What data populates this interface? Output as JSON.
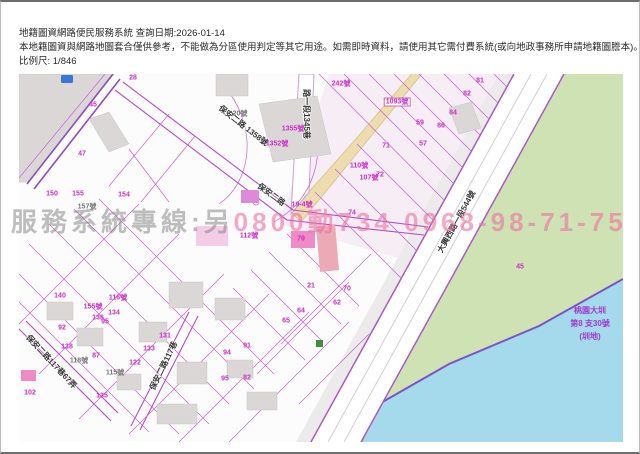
{
  "header": {
    "system_title_line": "地籍圖資網路便民服務系統 查詢日期:2026-01-14",
    "disclaimer_line": "本地籍圖資與網路地圖套合僅供參考，不能做為分區使用判定等其它用途。如需即時資料，請使用其它需付費系統(或向地政事務所申請地籍圖謄本)。",
    "scale_label": "比例尺: 1/846"
  },
  "watermark": {
    "service_text": "服務系統專線:另",
    "phone_text": "0800動734 0968-98-71-75"
  },
  "map": {
    "colors": {
      "map_bg": "#fdfcfc",
      "parcel_line": "#c95fd0",
      "road_edge": "#a85cc0",
      "water": "#a5d9ec",
      "field_green": "#cfe2b4",
      "building_gray": "#dbd7d7",
      "road_tan": "#ecdcae",
      "label_magenta": "#cb2ecb",
      "canal_text": "#a23ad6"
    },
    "labels": [
      {
        "text": "保安二路 1358號",
        "x": 224,
        "y": 52,
        "rot": 38,
        "cls": "lbl-road",
        "name": "road-label-baoan-2rd-1358"
      },
      {
        "text": "保安二路",
        "x": 252,
        "y": 121,
        "rot": 36,
        "cls": "lbl-road",
        "name": "road-label-baoan-2rd"
      },
      {
        "text": "路一段1345巷",
        "x": 287,
        "y": 40,
        "rot": 90,
        "cls": "lbl-road",
        "name": "road-label-lane-1345"
      },
      {
        "text": "大興西路一段544號",
        "x": 438,
        "y": 148,
        "rot": -61,
        "cls": "lbl-road",
        "name": "road-label-daxing-w-rd-544"
      },
      {
        "text": "保安二路117巷67弄",
        "x": 32,
        "y": 288,
        "rot": 47,
        "cls": "lbl-road",
        "name": "road-label-lane-117-alley-67"
      },
      {
        "text": "保安二路117巷",
        "x": 145,
        "y": 292,
        "rot": -64,
        "cls": "lbl-road",
        "name": "road-label-lane-117"
      },
      {
        "text": "桃園大圳",
        "x": 571,
        "y": 237,
        "cls": "lbl-canal",
        "name": "canal-label-line1"
      },
      {
        "text": "第8 支30號",
        "x": 571,
        "y": 250,
        "cls": "lbl-canal",
        "name": "canal-label-line2"
      },
      {
        "text": "(圳地)",
        "x": 571,
        "y": 263,
        "cls": "lbl-canal",
        "name": "canal-label-line3"
      },
      {
        "text": "242號",
        "x": 322,
        "y": 10,
        "cls": "lbl-parcel"
      },
      {
        "text": "1093號",
        "x": 378,
        "y": 28,
        "cls": "lbl-parcel lbl-box"
      },
      {
        "text": "1355號",
        "x": 274,
        "y": 55,
        "cls": "lbl-parcel"
      },
      {
        "text": "1352號",
        "x": 258,
        "y": 70,
        "cls": "lbl-parcel"
      },
      {
        "text": "20號",
        "x": 221,
        "y": 40,
        "cls": "lbl-gray"
      },
      {
        "text": "110號",
        "x": 340,
        "y": 92,
        "cls": "lbl-parcel"
      },
      {
        "text": "107號",
        "x": 350,
        "y": 104,
        "cls": "lbl-parcel"
      },
      {
        "text": "19-4號",
        "x": 283,
        "y": 131,
        "cls": "lbl-parcel"
      },
      {
        "text": "112號",
        "x": 230,
        "y": 162,
        "cls": "lbl-parcel"
      },
      {
        "text": "157號",
        "x": 68,
        "y": 133,
        "cls": "lbl-gray"
      },
      {
        "text": "155號",
        "x": 74,
        "y": 233,
        "cls": "lbl-parcel"
      },
      {
        "text": "116號",
        "x": 99,
        "y": 224,
        "cls": "lbl-parcel"
      },
      {
        "text": "118號",
        "x": 60,
        "y": 287,
        "cls": "lbl-gray"
      },
      {
        "text": "115號",
        "x": 96,
        "y": 299,
        "cls": "lbl-gray"
      },
      {
        "text": "45",
        "x": 74,
        "y": 31,
        "cls": "lbl-parcel"
      },
      {
        "text": "28",
        "x": 114,
        "y": 4,
        "cls": "lbl-parcel"
      },
      {
        "text": "47",
        "x": 63,
        "y": 80,
        "cls": "lbl-parcel"
      },
      {
        "text": "81",
        "x": 461,
        "y": 7,
        "cls": "lbl-parcel"
      },
      {
        "text": "82",
        "x": 448,
        "y": 20,
        "cls": "lbl-parcel"
      },
      {
        "text": "84",
        "x": 434,
        "y": 39,
        "cls": "lbl-parcel"
      },
      {
        "text": "86",
        "x": 422,
        "y": 52,
        "cls": "lbl-parcel"
      },
      {
        "text": "59",
        "x": 401,
        "y": 49,
        "cls": "lbl-parcel"
      },
      {
        "text": "57",
        "x": 404,
        "y": 70,
        "cls": "lbl-parcel"
      },
      {
        "text": "71",
        "x": 367,
        "y": 72,
        "cls": "lbl-parcel"
      },
      {
        "text": "72",
        "x": 361,
        "y": 101,
        "cls": "lbl-parcel"
      },
      {
        "text": "74",
        "x": 333,
        "y": 139,
        "cls": "lbl-parcel"
      },
      {
        "text": "79",
        "x": 282,
        "y": 165,
        "cls": "lbl-parcel"
      },
      {
        "text": "150",
        "x": 33,
        "y": 120,
        "cls": "lbl-parcel"
      },
      {
        "text": "155",
        "x": 59,
        "y": 120,
        "cls": "lbl-parcel"
      },
      {
        "text": "154",
        "x": 105,
        "y": 121,
        "cls": "lbl-parcel"
      },
      {
        "text": "140",
        "x": 41,
        "y": 222,
        "cls": "lbl-parcel"
      },
      {
        "text": "136",
        "x": 79,
        "y": 244,
        "cls": "lbl-parcel"
      },
      {
        "text": "134",
        "x": 95,
        "y": 239,
        "cls": "lbl-parcel"
      },
      {
        "text": "95",
        "x": 86,
        "y": 248,
        "cls": "lbl-parcel"
      },
      {
        "text": "92",
        "x": 43,
        "y": 254,
        "cls": "lbl-parcel"
      },
      {
        "text": "138",
        "x": 48,
        "y": 273,
        "cls": "lbl-parcel"
      },
      {
        "text": "87",
        "x": 77,
        "y": 282,
        "cls": "lbl-parcel"
      },
      {
        "text": "122",
        "x": 116,
        "y": 289,
        "cls": "lbl-parcel"
      },
      {
        "text": "133",
        "x": 130,
        "y": 275,
        "cls": "lbl-parcel"
      },
      {
        "text": "131",
        "x": 146,
        "y": 262,
        "cls": "lbl-parcel"
      },
      {
        "text": "94",
        "x": 208,
        "y": 279,
        "cls": "lbl-parcel"
      },
      {
        "text": "91",
        "x": 228,
        "y": 272,
        "cls": "lbl-parcel"
      },
      {
        "text": "95",
        "x": 206,
        "y": 305,
        "cls": "lbl-parcel"
      },
      {
        "text": "82",
        "x": 228,
        "y": 304,
        "cls": "lbl-parcel"
      },
      {
        "text": "102",
        "x": 11,
        "y": 319,
        "cls": "lbl-parcel"
      },
      {
        "text": "135",
        "x": 83,
        "y": 322,
        "cls": "lbl-parcel"
      },
      {
        "text": "21",
        "x": 292,
        "y": 212,
        "cls": "lbl-parcel"
      },
      {
        "text": "70",
        "x": 328,
        "y": 215,
        "cls": "lbl-parcel"
      },
      {
        "text": "62",
        "x": 318,
        "y": 229,
        "cls": "lbl-parcel"
      },
      {
        "text": "64",
        "x": 282,
        "y": 237,
        "cls": "lbl-parcel"
      },
      {
        "text": "65",
        "x": 267,
        "y": 247,
        "cls": "lbl-parcel"
      },
      {
        "text": "45",
        "x": 501,
        "y": 193,
        "cls": "lbl-parcel"
      }
    ]
  }
}
